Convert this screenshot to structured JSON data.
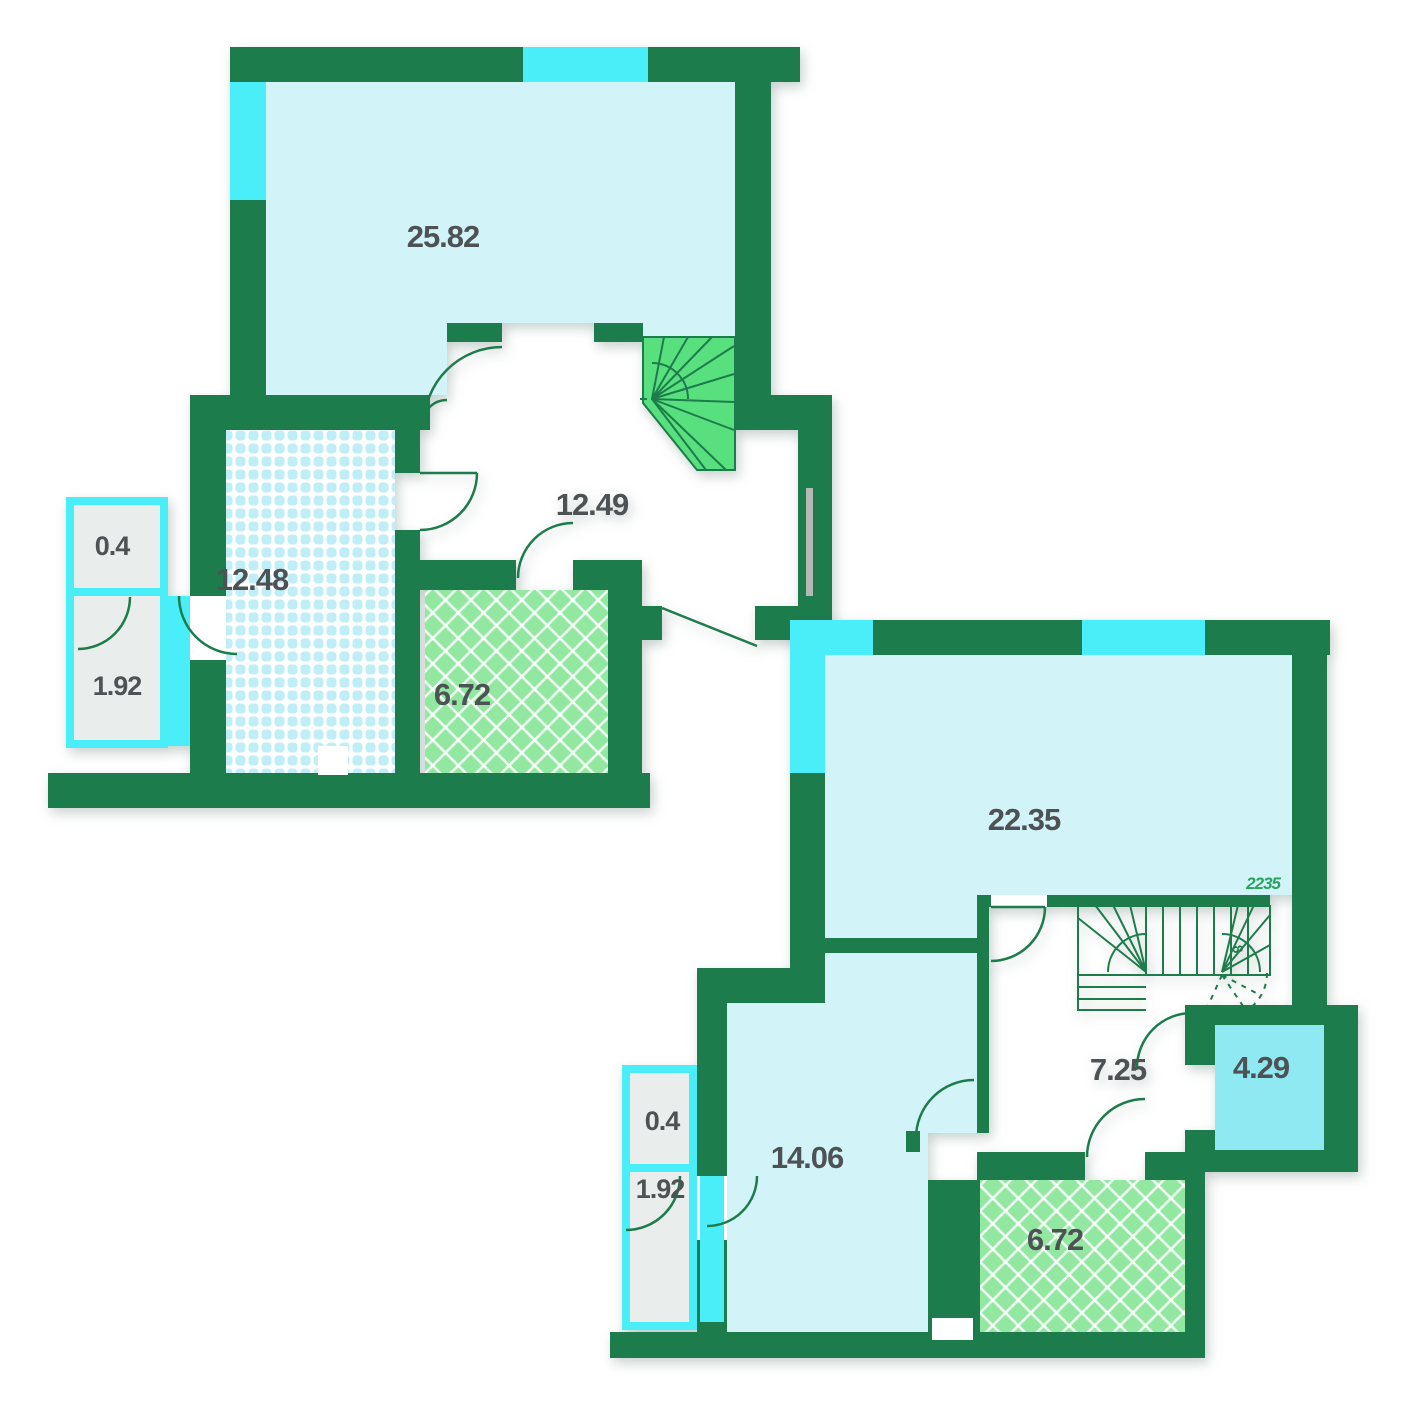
{
  "document": {
    "type": "floor-plan",
    "levels": "2"
  },
  "colors": {
    "wall": "#1d7c4b",
    "window": "#4aeef8",
    "room_fill": "#d2f3f7",
    "accent_room_fill": "#8fe9f2",
    "stair_fill": "#58e07e",
    "bathroom_fill": "#92e8a0",
    "balcony_fill": "#e9edeb",
    "label": "#4d5355",
    "watermark": "#27a35f"
  },
  "upper_plan": {
    "rooms": [
      {
        "name": "living-room",
        "area": "25.82"
      },
      {
        "name": "hall",
        "area": "12.49"
      },
      {
        "name": "bedroom",
        "area": "12.48"
      },
      {
        "name": "bathroom",
        "area": "6.72"
      },
      {
        "name": "balcony-upper-section",
        "area": "0.4"
      },
      {
        "name": "balcony-lower-section",
        "area": "1.92"
      }
    ]
  },
  "lower_plan": {
    "rooms": [
      {
        "name": "living-room",
        "area": "22.35"
      },
      {
        "name": "hall",
        "area": "7.25"
      },
      {
        "name": "storage",
        "area": "4.29"
      },
      {
        "name": "bedroom",
        "area": "14.06"
      },
      {
        "name": "bathroom",
        "area": "6.72"
      },
      {
        "name": "balcony-upper-section",
        "area": "0.4"
      },
      {
        "name": "balcony-lower-section",
        "area": "1.92"
      }
    ],
    "watermark": "2235",
    "stair_step_count": "8"
  }
}
